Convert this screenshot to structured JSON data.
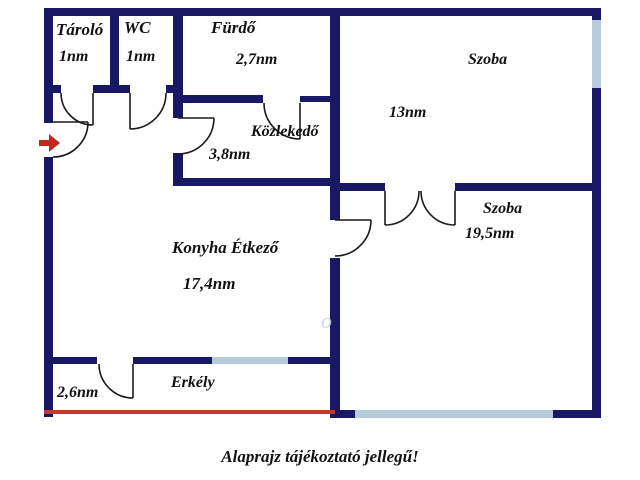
{
  "floorplan": {
    "caption": "Alaprajz tájékoztató jellegű!",
    "watermark": "o",
    "colors": {
      "wall": "#181865",
      "window": "#b7cbdb",
      "balcony_line": "#c23b2e",
      "entry_arrow": "#c0281e",
      "door_line": "#1a1a1a",
      "label": "#111111",
      "background": "#ffffff"
    },
    "rooms": {
      "tarolo": {
        "name": "Tároló",
        "area": "1nm"
      },
      "wc": {
        "name": "WC",
        "area": "1nm"
      },
      "furdo": {
        "name": "Fürdő",
        "area": "2,7nm"
      },
      "kozlekedo": {
        "name": "Közlekedő",
        "area": "3,8nm"
      },
      "szoba_felso": {
        "name": "Szoba",
        "area": "13nm"
      },
      "szoba_also": {
        "name": "Szoba",
        "area": "19,5nm"
      },
      "konyha": {
        "name": "Konyha Étkező",
        "area": "17,4nm"
      },
      "erkely": {
        "name": "Erkély",
        "area": "2,6nm"
      }
    }
  }
}
